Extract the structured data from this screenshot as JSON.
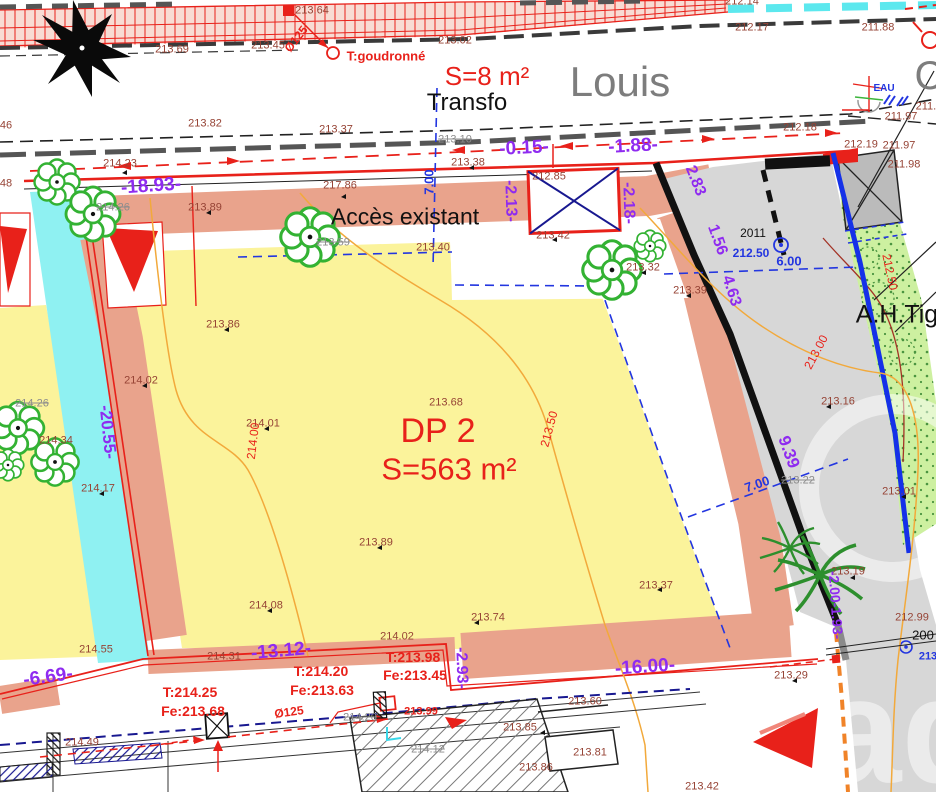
{
  "plan": {
    "parcel_id": "DP 2",
    "parcel_area": "S=563 m²",
    "transformer_label": "Transfo",
    "transformer_area": "S=8 m²",
    "street_name": "Louis",
    "access_note": "Accès existant",
    "neighbor_label": "A.H.Tig",
    "road_surface_note": "T:goudronné",
    "water_label": "EAU",
    "survey_year": "2011"
  },
  "watermark": {
    "text": "ad"
  },
  "colors": {
    "parcel_fill": "#fbf39b",
    "border_band": "#e9a38c",
    "water_strip": "#8ff1f2",
    "road_gray": "#d7d7d7",
    "vegetation": "#cdf0a0",
    "dimension_purple": "#8f2bf0",
    "survey_red": "#e8211a",
    "elevation_brown": "#964335",
    "utility_blue": "#2336e0",
    "contour_orange": "#f2a93b"
  },
  "symbols": [
    "compass-rose",
    "tree-symbol",
    "bush-symbol",
    "palm-tree-symbol",
    "transformer-hatch-box",
    "manhole-cross-box",
    "water-valve-symbol",
    "survey-point-tick",
    "flow-arrow",
    "benchmark-circle"
  ],
  "labels": [
    {
      "text": "213.64",
      "x": 312,
      "y": 11,
      "cls": "e"
    },
    {
      "text": "213.69",
      "x": 172,
      "y": 50,
      "cls": "e"
    },
    {
      "text": "213.45",
      "x": 268,
      "y": 46,
      "cls": "e"
    },
    {
      "text": "213.02",
      "x": 455,
      "y": 41,
      "cls": "e"
    },
    {
      "text": "212.14",
      "x": 742,
      "y": 2,
      "cls": "e"
    },
    {
      "text": "212.17",
      "x": 752,
      "y": 28,
      "cls": "e"
    },
    {
      "text": "211.88",
      "x": 878,
      "y": 28,
      "cls": "e"
    },
    {
      "text": "213.82",
      "x": 205,
      "y": 124,
      "cls": "e"
    },
    {
      "text": "213.37",
      "x": 336,
      "y": 130,
      "cls": "e"
    },
    {
      "text": "213.10",
      "x": 455,
      "y": 140,
      "cls": "x"
    },
    {
      "text": "212.18",
      "x": 800,
      "y": 128,
      "cls": "e"
    },
    {
      "text": "211.97",
      "x": 901,
      "y": 117,
      "cls": "e"
    },
    {
      "text": "211.8",
      "x": 929,
      "y": 107,
      "cls": "e"
    },
    {
      "text": "212.19",
      "x": 861,
      "y": 145,
      "cls": "e"
    },
    {
      "text": "211.97",
      "x": 899,
      "y": 146,
      "cls": "e"
    },
    {
      "text": "211.98",
      "x": 904,
      "y": 165,
      "cls": "e"
    },
    {
      "text": "214.23",
      "x": 120,
      "y": 164,
      "cls": "e"
    },
    {
      "text": "214.26",
      "x": 113,
      "y": 208,
      "cls": "x"
    },
    {
      "text": "213.89",
      "x": 205,
      "y": 208,
      "cls": "e"
    },
    {
      "text": "217.86",
      "x": 340,
      "y": 186,
      "cls": "e"
    },
    {
      "text": "213.38",
      "x": 468,
      "y": 163,
      "cls": "e"
    },
    {
      "text": "212.85",
      "x": 549,
      "y": 177,
      "cls": "e"
    },
    {
      "text": "213.42",
      "x": 553,
      "y": 236,
      "cls": "e"
    },
    {
      "text": "213.32",
      "x": 643,
      "y": 268,
      "cls": "e"
    },
    {
      "text": "213.39",
      "x": 690,
      "y": 291,
      "cls": "e"
    },
    {
      "text": "213.59",
      "x": 333,
      "y": 243,
      "cls": "x"
    },
    {
      "text": "213.40",
      "x": 433,
      "y": 248,
      "cls": "e"
    },
    {
      "text": "213.86",
      "x": 223,
      "y": 325,
      "cls": "e"
    },
    {
      "text": "214.02",
      "x": 141,
      "y": 381,
      "cls": "e"
    },
    {
      "text": "213.68",
      "x": 446,
      "y": 403,
      "cls": "e"
    },
    {
      "text": "214.01",
      "x": 263,
      "y": 424,
      "cls": "e"
    },
    {
      "text": "214.34",
      "x": 56,
      "y": 441,
      "cls": "e"
    },
    {
      "text": "214.26",
      "x": 32,
      "y": 404,
      "cls": "x"
    },
    {
      "text": "214.17",
      "x": 98,
      "y": 489,
      "cls": "e"
    },
    {
      "text": "213.89",
      "x": 376,
      "y": 543,
      "cls": "e"
    },
    {
      "text": "214.08",
      "x": 266,
      "y": 606,
      "cls": "e"
    },
    {
      "text": "213.74",
      "x": 488,
      "y": 618,
      "cls": "e"
    },
    {
      "text": "213.37",
      "x": 656,
      "y": 586,
      "cls": "e"
    },
    {
      "text": "214.55",
      "x": 96,
      "y": 650,
      "cls": "e"
    },
    {
      "text": "214.31",
      "x": 224,
      "y": 657,
      "cls": "e"
    },
    {
      "text": "214.02",
      "x": 397,
      "y": 637,
      "cls": "e"
    },
    {
      "text": "213.60",
      "x": 585,
      "y": 702,
      "cls": "e"
    },
    {
      "text": "213.29",
      "x": 791,
      "y": 676,
      "cls": "e"
    },
    {
      "text": "212.99",
      "x": 912,
      "y": 618,
      "cls": "e"
    },
    {
      "text": "213.16",
      "x": 838,
      "y": 402,
      "cls": "e"
    },
    {
      "text": "213.01",
      "x": 899,
      "y": 492,
      "cls": "e"
    },
    {
      "text": "213.22",
      "x": 798,
      "y": 481,
      "cls": "x"
    },
    {
      "text": "213.19",
      "x": 848,
      "y": 572,
      "cls": "e"
    },
    {
      "text": "213.85",
      "x": 520,
      "y": 728,
      "cls": "e"
    },
    {
      "text": "214.12",
      "x": 428,
      "y": 750,
      "cls": "x"
    },
    {
      "text": "214.20",
      "x": 360,
      "y": 718,
      "cls": "x"
    },
    {
      "text": "213.86",
      "x": 536,
      "y": 768,
      "cls": "e"
    },
    {
      "text": "213.81",
      "x": 590,
      "y": 753,
      "cls": "e"
    },
    {
      "text": "213.42",
      "x": 702,
      "y": 787,
      "cls": "e"
    },
    {
      "text": "214.49",
      "x": 82,
      "y": 743,
      "cls": "e"
    },
    {
      "text": "46",
      "x": 6,
      "y": 126,
      "cls": "e"
    },
    {
      "text": "48",
      "x": 6,
      "y": 184,
      "cls": "e"
    },
    {
      "text": "2011",
      "x": 753,
      "y": 233,
      "cls": "k",
      "fs": 12,
      "name": "survey-year-label"
    },
    {
      "text": "200",
      "x": 923,
      "y": 635,
      "cls": "k",
      "fs": 13
    },
    {
      "text": "213",
      "x": 928,
      "y": 657,
      "cls": "b",
      "fs": 11
    },
    {
      "text": "S=8 m²",
      "x": 487,
      "y": 76,
      "cls": "R",
      "fs": 26,
      "name": "transfo-area-label"
    },
    {
      "text": "T:goudronné",
      "x": 386,
      "y": 56,
      "cls": "r",
      "fs": 13,
      "name": "road-surface-label"
    },
    {
      "text": "DP 2",
      "x": 438,
      "y": 431,
      "cls": "R",
      "fs": 34,
      "name": "parcel-id-label"
    },
    {
      "text": "S=563 m²",
      "x": 449,
      "y": 469,
      "cls": "R",
      "fs": 31,
      "name": "parcel-area-label"
    },
    {
      "text": "T:214.25",
      "x": 190,
      "y": 692,
      "cls": "r",
      "fs": 14
    },
    {
      "text": "Fe:213.68",
      "x": 193,
      "y": 711,
      "cls": "r",
      "fs": 14
    },
    {
      "text": "T:214.20",
      "x": 321,
      "y": 671,
      "cls": "r",
      "fs": 14
    },
    {
      "text": "Fe:213.63",
      "x": 322,
      "y": 690,
      "cls": "r",
      "fs": 14
    },
    {
      "text": "T:213.98",
      "x": 413,
      "y": 657,
      "cls": "r",
      "fs": 14
    },
    {
      "text": "Fe:213.45",
      "x": 415,
      "y": 675,
      "cls": "r",
      "fs": 14
    },
    {
      "text": "Ø125",
      "x": 296,
      "y": 39,
      "rot": -52,
      "cls": "r",
      "fs": 12
    },
    {
      "text": "Ø125",
      "x": 289,
      "y": 712,
      "rot": -8,
      "cls": "r",
      "fs": 12
    },
    {
      "text": "213.99",
      "x": 421,
      "y": 712,
      "cls": "r",
      "fs": 11
    },
    {
      "text": "214.00",
      "x": 253,
      "y": 441,
      "rot": -83,
      "cls": "c",
      "fs": 12,
      "name": "contour-label"
    },
    {
      "text": "213.50",
      "x": 549,
      "y": 429,
      "rot": -75,
      "cls": "c",
      "fs": 12,
      "name": "contour-label"
    },
    {
      "text": "213.00",
      "x": 816,
      "y": 352,
      "rot": -62,
      "cls": "c",
      "fs": 12,
      "name": "contour-label"
    },
    {
      "text": "212.50",
      "x": 890,
      "y": 272,
      "rot": 78,
      "cls": "c",
      "fs": 12,
      "name": "contour-label"
    },
    {
      "text": "-18.93-",
      "x": 151,
      "y": 186,
      "rot": -4,
      "cls": "p",
      "fs": 19
    },
    {
      "text": "-0.15-",
      "x": 524,
      "y": 148,
      "rot": -3,
      "cls": "p",
      "fs": 19
    },
    {
      "text": "-1.88-",
      "x": 633,
      "y": 146,
      "rot": -3,
      "cls": "p",
      "fs": 19
    },
    {
      "text": "-2.13-",
      "x": 510,
      "y": 201,
      "rot": 88,
      "cls": "p",
      "fs": 16
    },
    {
      "text": "-2.18-",
      "x": 628,
      "y": 203,
      "rot": 88,
      "cls": "p",
      "fs": 16
    },
    {
      "text": "2.83",
      "x": 695,
      "y": 181,
      "rot": 68,
      "cls": "p",
      "fs": 16
    },
    {
      "text": "1.56",
      "x": 717,
      "y": 240,
      "rot": 70,
      "cls": "p",
      "fs": 16
    },
    {
      "text": "4.63",
      "x": 731,
      "y": 291,
      "rot": 72,
      "cls": "p",
      "fs": 16
    },
    {
      "text": "-20.55-",
      "x": 108,
      "y": 432,
      "rot": 84,
      "cls": "p",
      "fs": 17
    },
    {
      "text": "9.39",
      "x": 789,
      "y": 452,
      "rot": 70,
      "cls": "p",
      "fs": 17
    },
    {
      "text": "-13.12-",
      "x": 281,
      "y": 651,
      "rot": -5,
      "cls": "p",
      "fs": 19
    },
    {
      "text": "-2.93-",
      "x": 461,
      "y": 668,
      "rot": 88,
      "cls": "p",
      "fs": 16
    },
    {
      "text": "-16.00-",
      "x": 645,
      "y": 667,
      "rot": -4,
      "cls": "p",
      "fs": 19
    },
    {
      "text": "-6.69-",
      "x": 48,
      "y": 677,
      "rot": -8,
      "cls": "p",
      "fs": 19
    },
    {
      "text": "-2.00-1.93-",
      "x": 836,
      "y": 605,
      "rot": 86,
      "cls": "p",
      "fs": 14
    },
    {
      "text": "7.00",
      "x": 429,
      "y": 182,
      "rot": -90,
      "cls": "b",
      "fs": 13
    },
    {
      "text": "212.50",
      "x": 751,
      "y": 253,
      "cls": "b",
      "fs": 12
    },
    {
      "text": "6.00",
      "x": 789,
      "y": 261,
      "cls": "b",
      "fs": 13
    },
    {
      "text": "7.00",
      "x": 757,
      "y": 484,
      "rot": -19,
      "cls": "b",
      "fs": 13
    },
    {
      "text": "Transfo",
      "x": 467,
      "y": 103,
      "cls": "k",
      "fs": 24,
      "name": "transfo-label"
    },
    {
      "text": "Accès existant",
      "x": 405,
      "y": 217,
      "cls": "k",
      "fs": 23,
      "name": "access-label"
    },
    {
      "text": "A.H.Tig",
      "x": 897,
      "y": 315,
      "cls": "k",
      "fs": 25,
      "name": "neighbor-label"
    },
    {
      "text": "Louis",
      "x": 620,
      "y": 82,
      "cls": "G",
      "fs": 42,
      "name": "street-name-label"
    },
    {
      "text": "C",
      "x": 929,
      "y": 76,
      "cls": "G",
      "fs": 40
    },
    {
      "text": "EAU",
      "x": 884,
      "y": 89,
      "cls": "B",
      "fs": 10,
      "name": "water-label"
    }
  ]
}
